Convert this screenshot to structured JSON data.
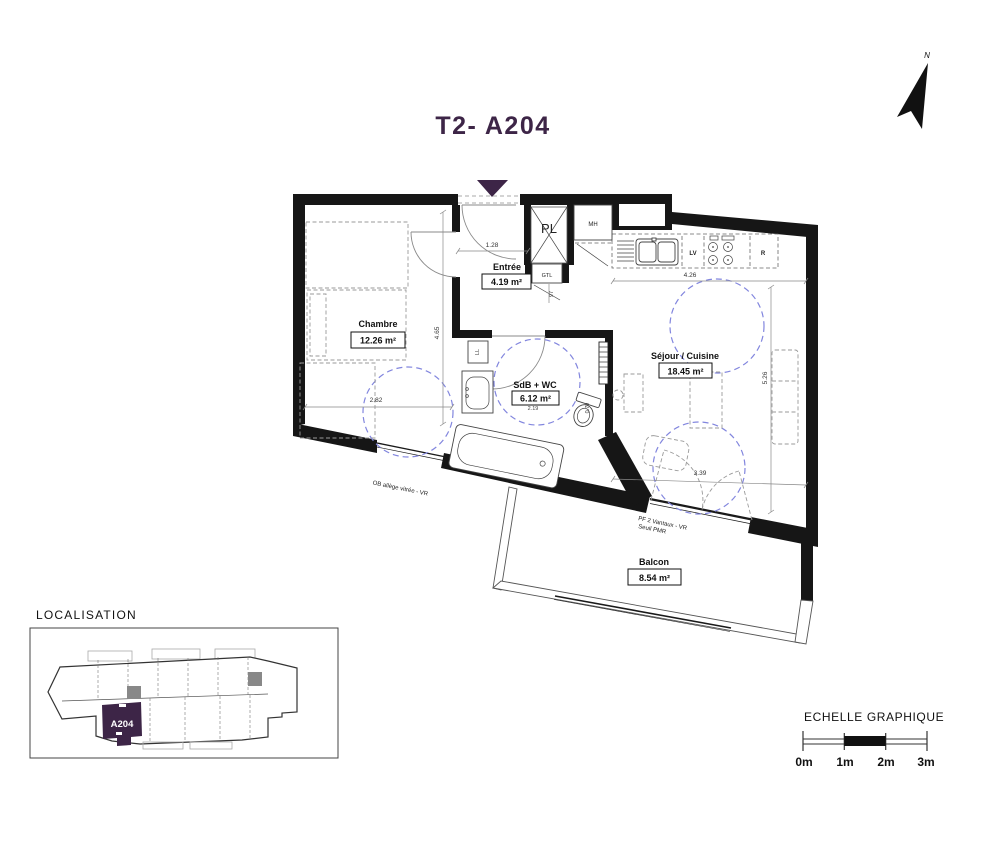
{
  "title": "T2- A204",
  "compass": {
    "label": "N"
  },
  "colors": {
    "accent": "#3d2547",
    "circulation": "#8286de",
    "wall": "#161616"
  },
  "rooms": [
    {
      "name": "Chambre",
      "area": "12.26 m²"
    },
    {
      "name": "Entrée",
      "area": "4.19 m²"
    },
    {
      "name": "SdB + WC",
      "area": "6.12 m²"
    },
    {
      "name": "Séjour / Cuisine",
      "area": "18.45 m²"
    },
    {
      "name": "Balcon",
      "area": "8.54 m²"
    }
  ],
  "fixtures": {
    "closet": "PL",
    "wall_cabinet": "MH",
    "electrical": "GTL",
    "washer": "LL",
    "dishwasher": "LV",
    "fridge": "R"
  },
  "dimensions": {
    "entree_width": "1.28",
    "chambre_depth": "4.65",
    "chambre_width": "2.82",
    "kitchen_width": "4.26",
    "sejour_depth": "5.26",
    "bay_width": "3.39",
    "passage_width": "97",
    "sdb_width": "2.19",
    "wc_clearance": "0.79"
  },
  "annotations": {
    "chambre_window": "OB allège vitrée - VR",
    "sejour_window_line1": "PF 2 Vantaux - VR",
    "sejour_window_line2": "Seuil PMR"
  },
  "localisation": {
    "heading": "LOCALISATION",
    "unit": "A204"
  },
  "scale_bar": {
    "heading": "ECHELLE GRAPHIQUE",
    "labels": [
      "0m",
      "1m",
      "2m",
      "3m"
    ]
  }
}
